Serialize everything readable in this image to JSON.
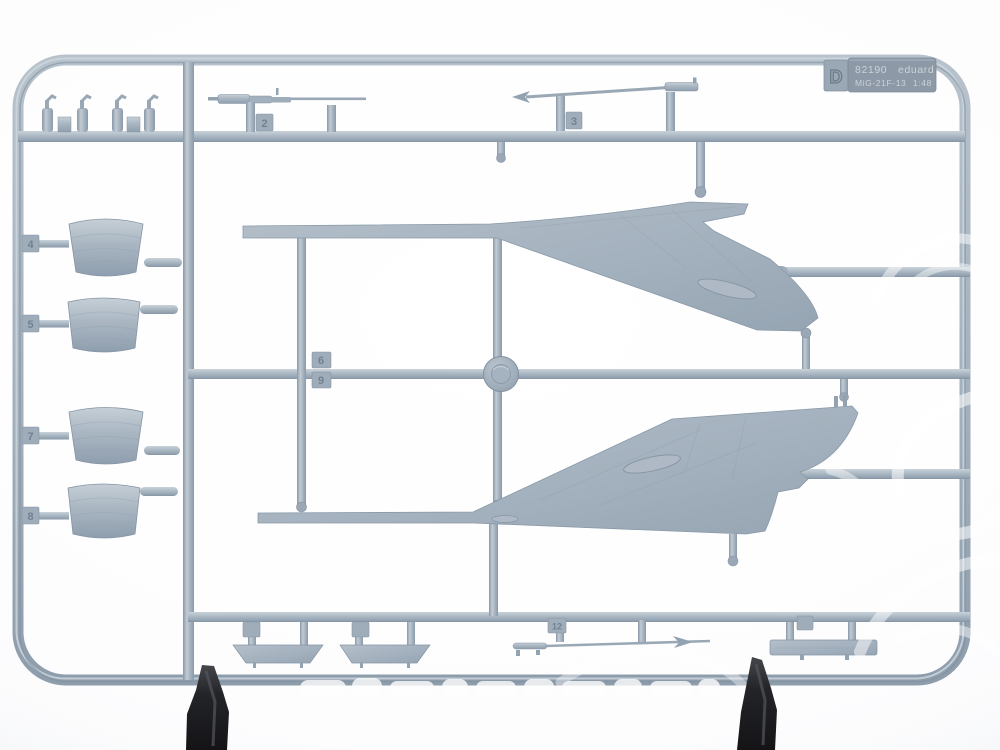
{
  "meta": {
    "subject": "photograph of an injection-moulded plastic model kit sprue held by two black clips",
    "plastic_color": "#a9b5c2",
    "background_color": "#f7f8f9",
    "clamp_color": "#1c1d20",
    "watermark_color": "#ffffff"
  },
  "sprue_label": {
    "letter": "D",
    "kit_number": "82190",
    "brand": "eduard",
    "subject": "MiG-21F-13",
    "scale": "1:48"
  },
  "part_number_tags": {
    "pitot_boom_upper": "2",
    "pitot_vane_upper": "3",
    "pitot_boom_lower": "12",
    "tank_1": "4",
    "tank_2": "5",
    "tank_3": "7",
    "tank_4": "8",
    "runner_tab_upper": "6",
    "runner_tab_lower": "9"
  },
  "parts_inventory": [
    "upper delta-wing half",
    "lower delta-wing half",
    "four drop-tank halves",
    "three pitot boom probes",
    "small cylindrical fittings",
    "two trapezoidal fin plates",
    "rectangular plate part",
    "central injection boss",
    "two black display clips"
  ]
}
